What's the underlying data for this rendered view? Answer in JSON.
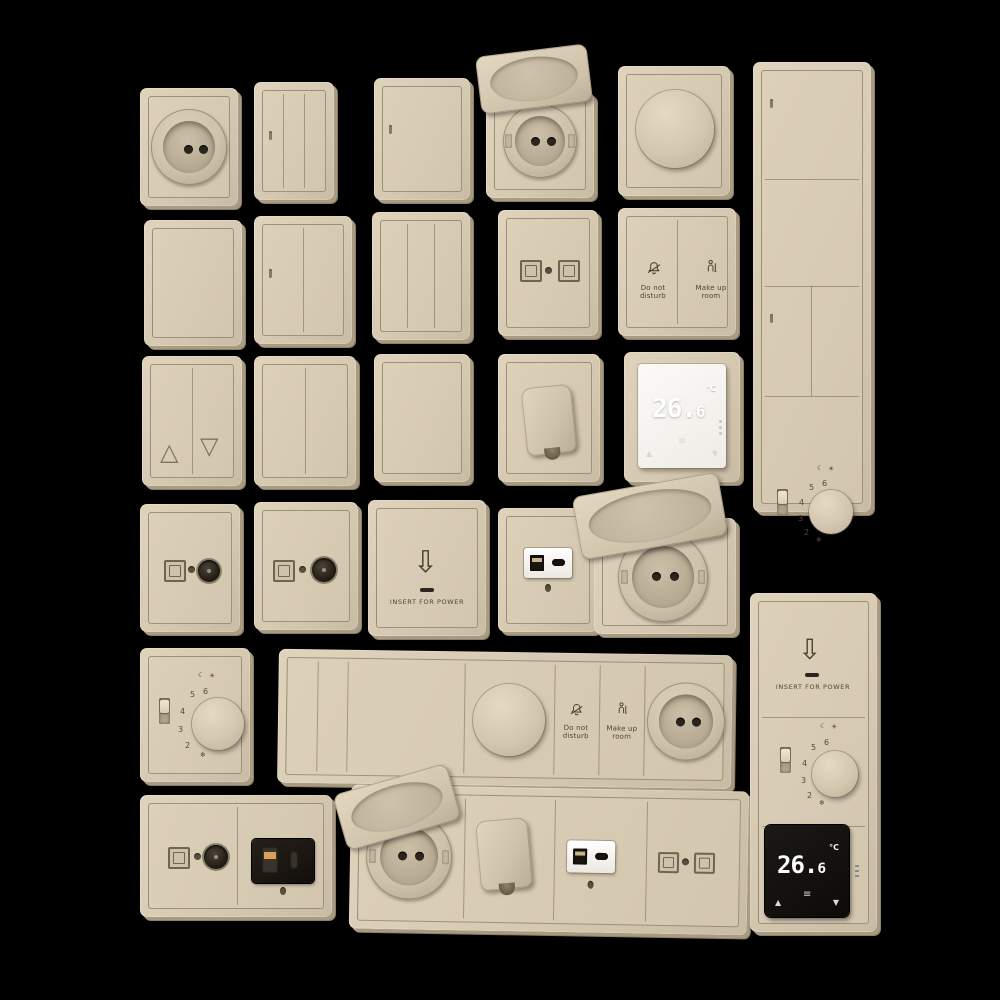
{
  "scene": {
    "background": "#000000",
    "description": "Beige hotel wall switches, sockets, dimmers and thermostats - 3D product lineup on black"
  },
  "palette": {
    "plate_beige": "#d6c9b1",
    "plate_edge": "#8d8069",
    "engraving": "#4d4436",
    "display_black": "#13100d",
    "display_white": "#f7f5f1",
    "usb_module_black": "#1c1813",
    "digit_white": "#ffffff"
  },
  "text": {
    "dnd": {
      "l1": "Do not",
      "l2": "disturb"
    },
    "mur": {
      "l1": "Make up",
      "l2": "room"
    },
    "card": {
      "arrow": "⇩",
      "label": "INSERT FOR POWER"
    },
    "thermo": {
      "temp_main": "26.",
      "temp_sub": "6",
      "unit": "°C",
      "up": "▲",
      "down": "▼",
      "menu": "≡"
    },
    "dial": {
      "numbers": [
        "6",
        "5",
        "4",
        "3",
        "2"
      ],
      "moon": "☾",
      "sun": "☀",
      "frost": "❄"
    },
    "blinds": {
      "up": "△",
      "down": "▽"
    }
  }
}
